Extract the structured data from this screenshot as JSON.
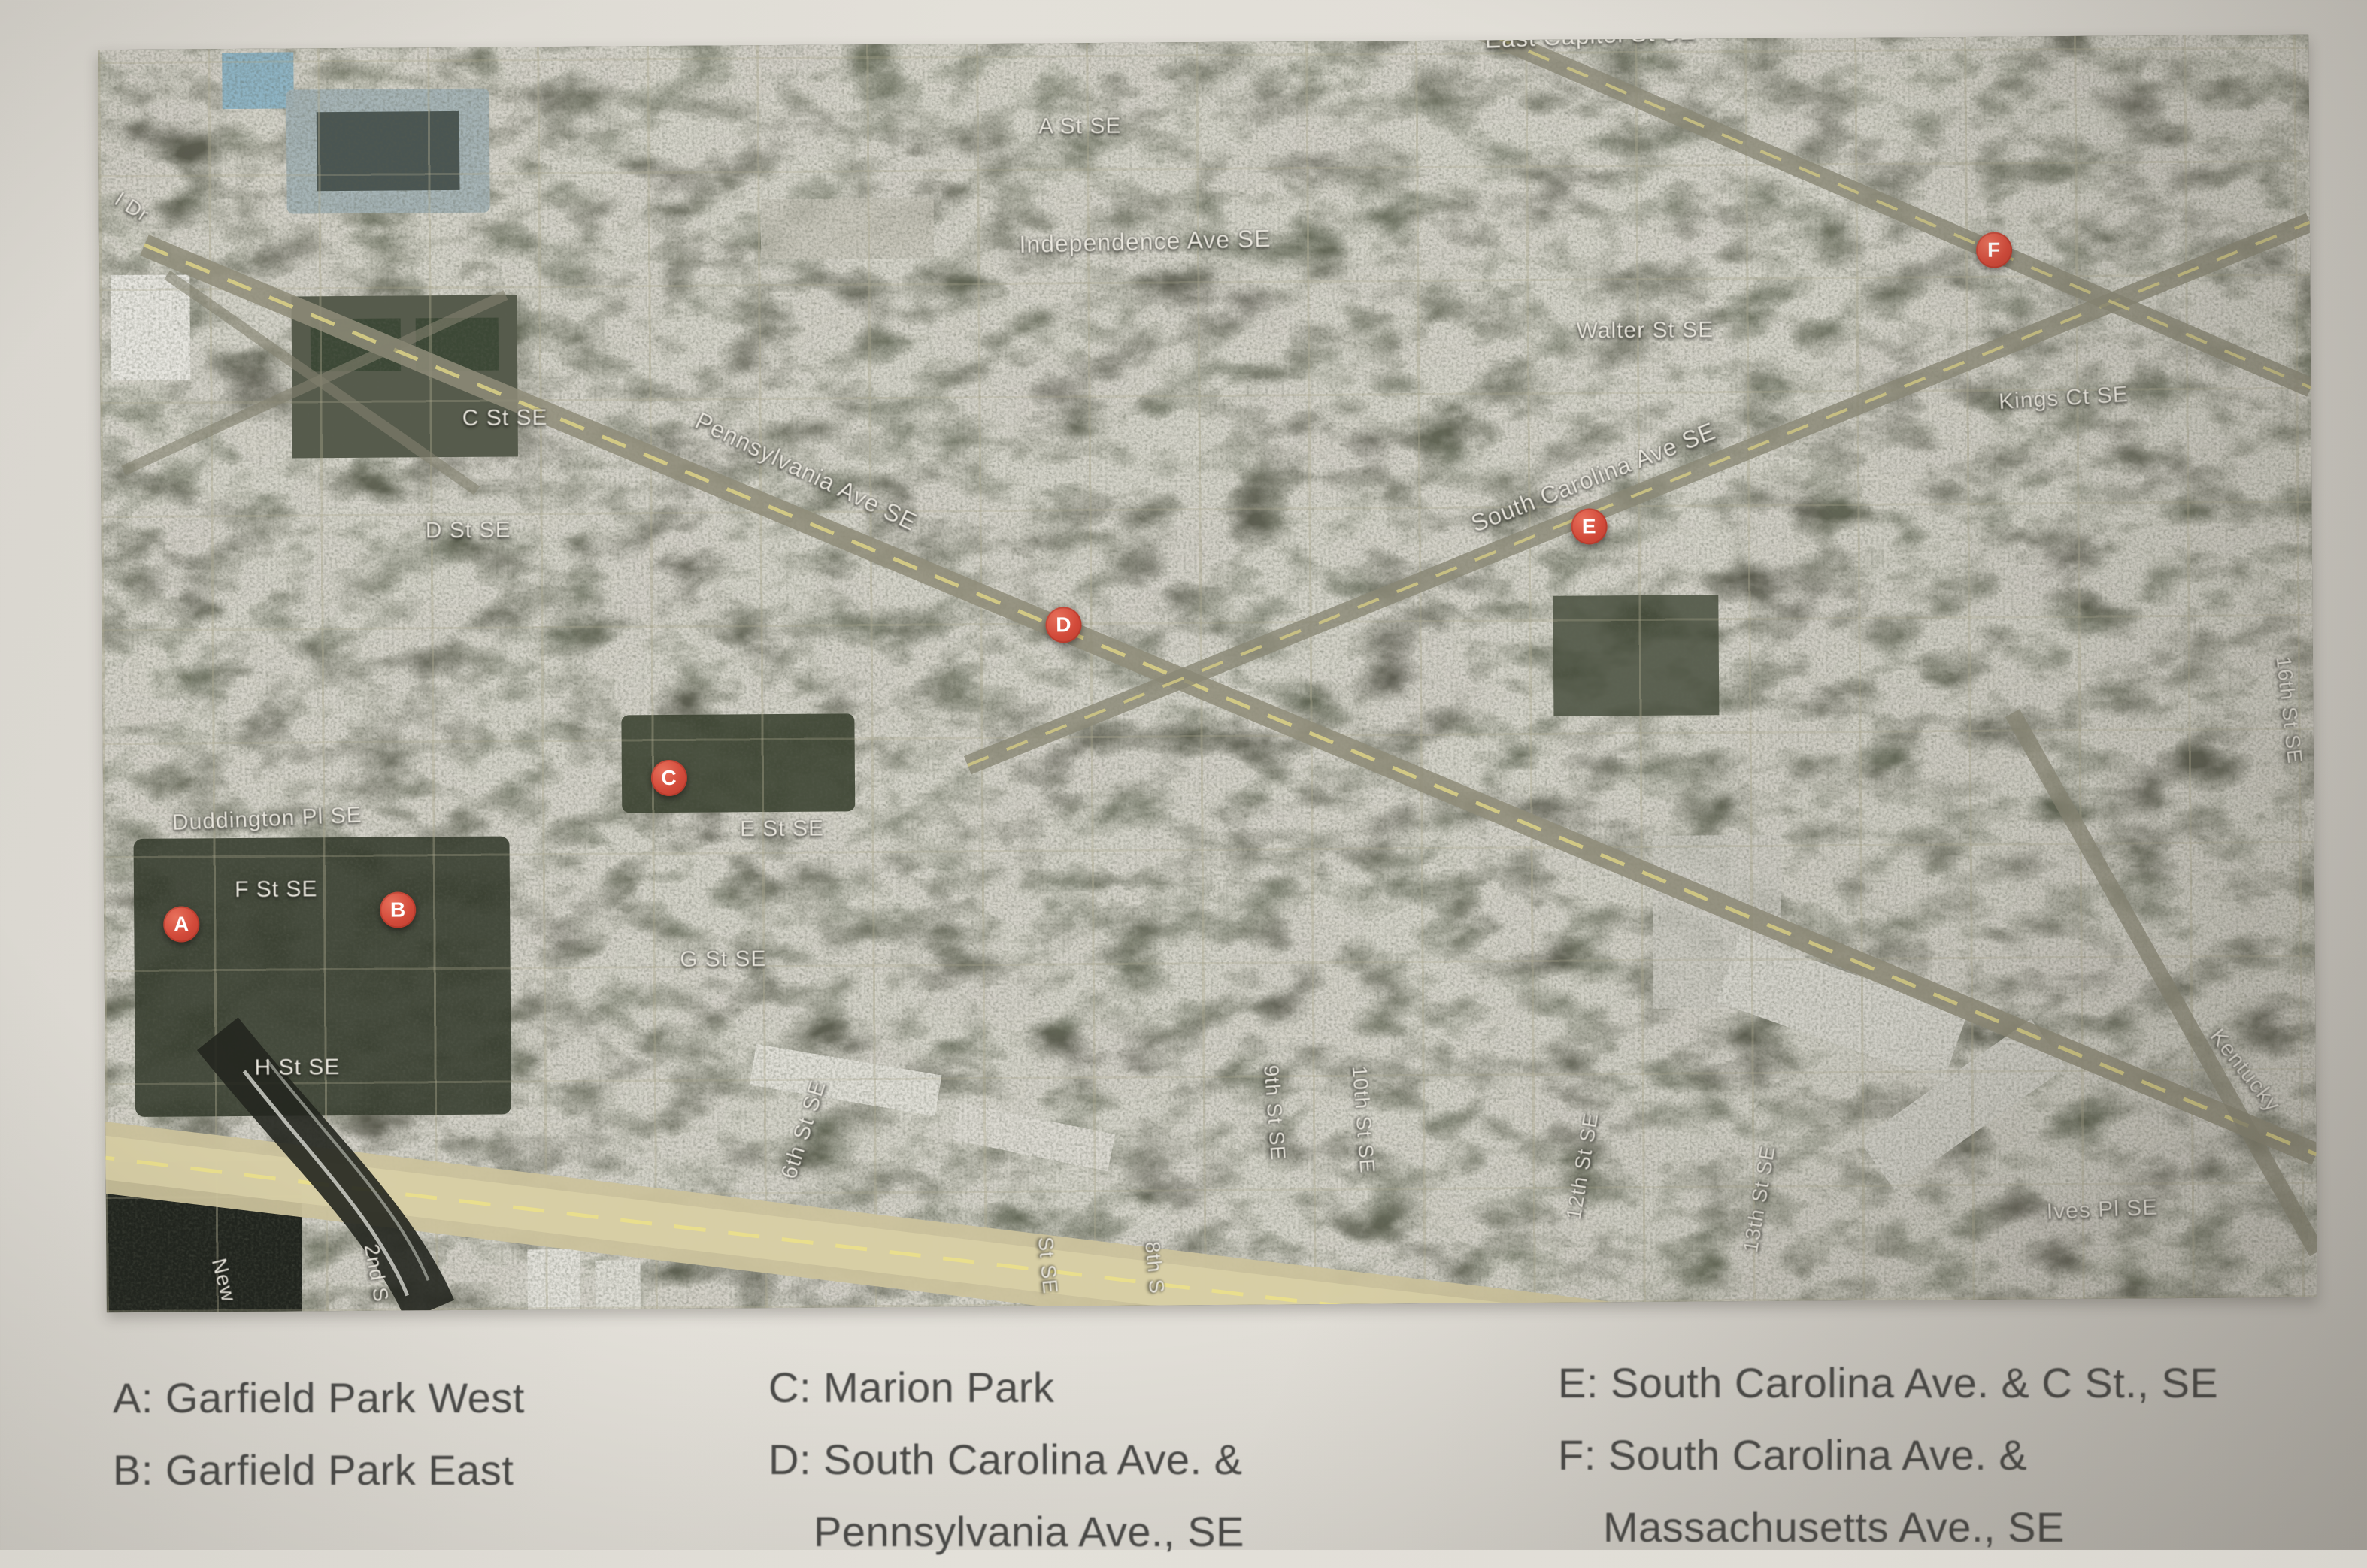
{
  "photo": {
    "paper_color": "#e0ddd6"
  },
  "map": {
    "marker_color": "#d24a3a",
    "markers": [
      {
        "letter": "A",
        "x": 3.5,
        "y": 69.3
      },
      {
        "letter": "B",
        "x": 13.3,
        "y": 68.3
      },
      {
        "letter": "C",
        "x": 25.6,
        "y": 58.0
      },
      {
        "letter": "D",
        "x": 43.5,
        "y": 46.1
      },
      {
        "letter": "E",
        "x": 67.3,
        "y": 38.6
      },
      {
        "letter": "F",
        "x": 85.7,
        "y": 16.9
      }
    ],
    "street_labels": [
      {
        "text": "East Capitol St SE",
        "x": 67.5,
        "y": -0.3,
        "rot": -2,
        "size": 32
      },
      {
        "text": "A St SE",
        "x": 44.4,
        "y": 6.6,
        "rot": 0,
        "size": 30
      },
      {
        "text": "Independence Ave SE",
        "x": 47.3,
        "y": 15.8,
        "rot": -1,
        "size": 32
      },
      {
        "text": "Walter St SE",
        "x": 69.9,
        "y": 23.1,
        "rot": 0,
        "size": 30
      },
      {
        "text": "Kings Ct SE",
        "x": 88.8,
        "y": 28.7,
        "rot": -3,
        "size": 30
      },
      {
        "text": "South Carolina Ave SE",
        "x": 67.5,
        "y": 34.7,
        "rot": -21,
        "size": 32
      },
      {
        "text": "Pennsylvania Ave SE",
        "x": 31.9,
        "y": 33.8,
        "rot": 26,
        "size": 32
      },
      {
        "text": "C St SE",
        "x": 18.3,
        "y": 29.4,
        "rot": 0,
        "size": 30
      },
      {
        "text": "D St SE",
        "x": 16.6,
        "y": 38.3,
        "rot": 0,
        "size": 30
      },
      {
        "text": "E St SE",
        "x": 30.7,
        "y": 62.1,
        "rot": 0,
        "size": 30
      },
      {
        "text": "Duddington Pl SE",
        "x": 7.4,
        "y": 61.0,
        "rot": -2,
        "size": 30
      },
      {
        "text": "F St SE",
        "x": 7.8,
        "y": 66.6,
        "rot": 0,
        "size": 30
      },
      {
        "text": "G St SE",
        "x": 28.0,
        "y": 72.4,
        "rot": 0,
        "size": 30
      },
      {
        "text": "H St SE",
        "x": 8.7,
        "y": 80.7,
        "rot": 0,
        "size": 30
      },
      {
        "text": "6th St SE",
        "x": 31.6,
        "y": 85.9,
        "rot": -72,
        "size": 30
      },
      {
        "text": "9th St SE",
        "x": 52.9,
        "y": 84.8,
        "rot": 86,
        "size": 28
      },
      {
        "text": "10th St SE",
        "x": 56.9,
        "y": 85.4,
        "rot": 86,
        "size": 28
      },
      {
        "text": "12th St SE",
        "x": 66.8,
        "y": 89.2,
        "rot": -80,
        "size": 28
      },
      {
        "text": "13th St SE",
        "x": 74.8,
        "y": 91.9,
        "rot": -80,
        "size": 28
      },
      {
        "text": "16th St SE",
        "x": 98.9,
        "y": 53.5,
        "rot": 84,
        "size": 28
      },
      {
        "text": "Kentucky",
        "x": 96.8,
        "y": 82.0,
        "rot": 52,
        "size": 30
      },
      {
        "text": "Ives Pl SE",
        "x": 90.3,
        "y": 93.0,
        "rot": -2,
        "size": 30
      },
      {
        "text": "New",
        "x": 5.3,
        "y": 97.5,
        "rot": 76,
        "size": 28
      },
      {
        "text": "2nd S",
        "x": 12.2,
        "y": 97.0,
        "rot": 80,
        "size": 28
      },
      {
        "text": "St SE",
        "x": 42.6,
        "y": 96.8,
        "rot": 85,
        "size": 28
      },
      {
        "text": "8th S",
        "x": 47.4,
        "y": 97.0,
        "rot": 85,
        "size": 28
      },
      {
        "text": "SE",
        "x": -0.9,
        "y": 93.5,
        "rot": 80,
        "size": 28
      },
      {
        "text": "l Dr",
        "x": 1.5,
        "y": 12.5,
        "rot": 33,
        "size": 28
      }
    ]
  },
  "legend": {
    "columns": [
      {
        "lines": [
          {
            "text": "A: Garfield Park West",
            "indent": false
          },
          {
            "text": "B: Garfield Park East",
            "indent": false
          }
        ]
      },
      {
        "lines": [
          {
            "text": "C: Marion Park",
            "indent": false
          },
          {
            "text": "D: South Carolina Ave. &",
            "indent": false
          },
          {
            "text": "Pennsylvania Ave., SE",
            "indent": true
          }
        ]
      },
      {
        "lines": [
          {
            "text": "E: South Carolina Ave. & C St., SE",
            "indent": false
          },
          {
            "text": "F: South Carolina Ave. &",
            "indent": false
          },
          {
            "text": "Massachusetts Ave., SE",
            "indent": true
          }
        ]
      }
    ]
  }
}
